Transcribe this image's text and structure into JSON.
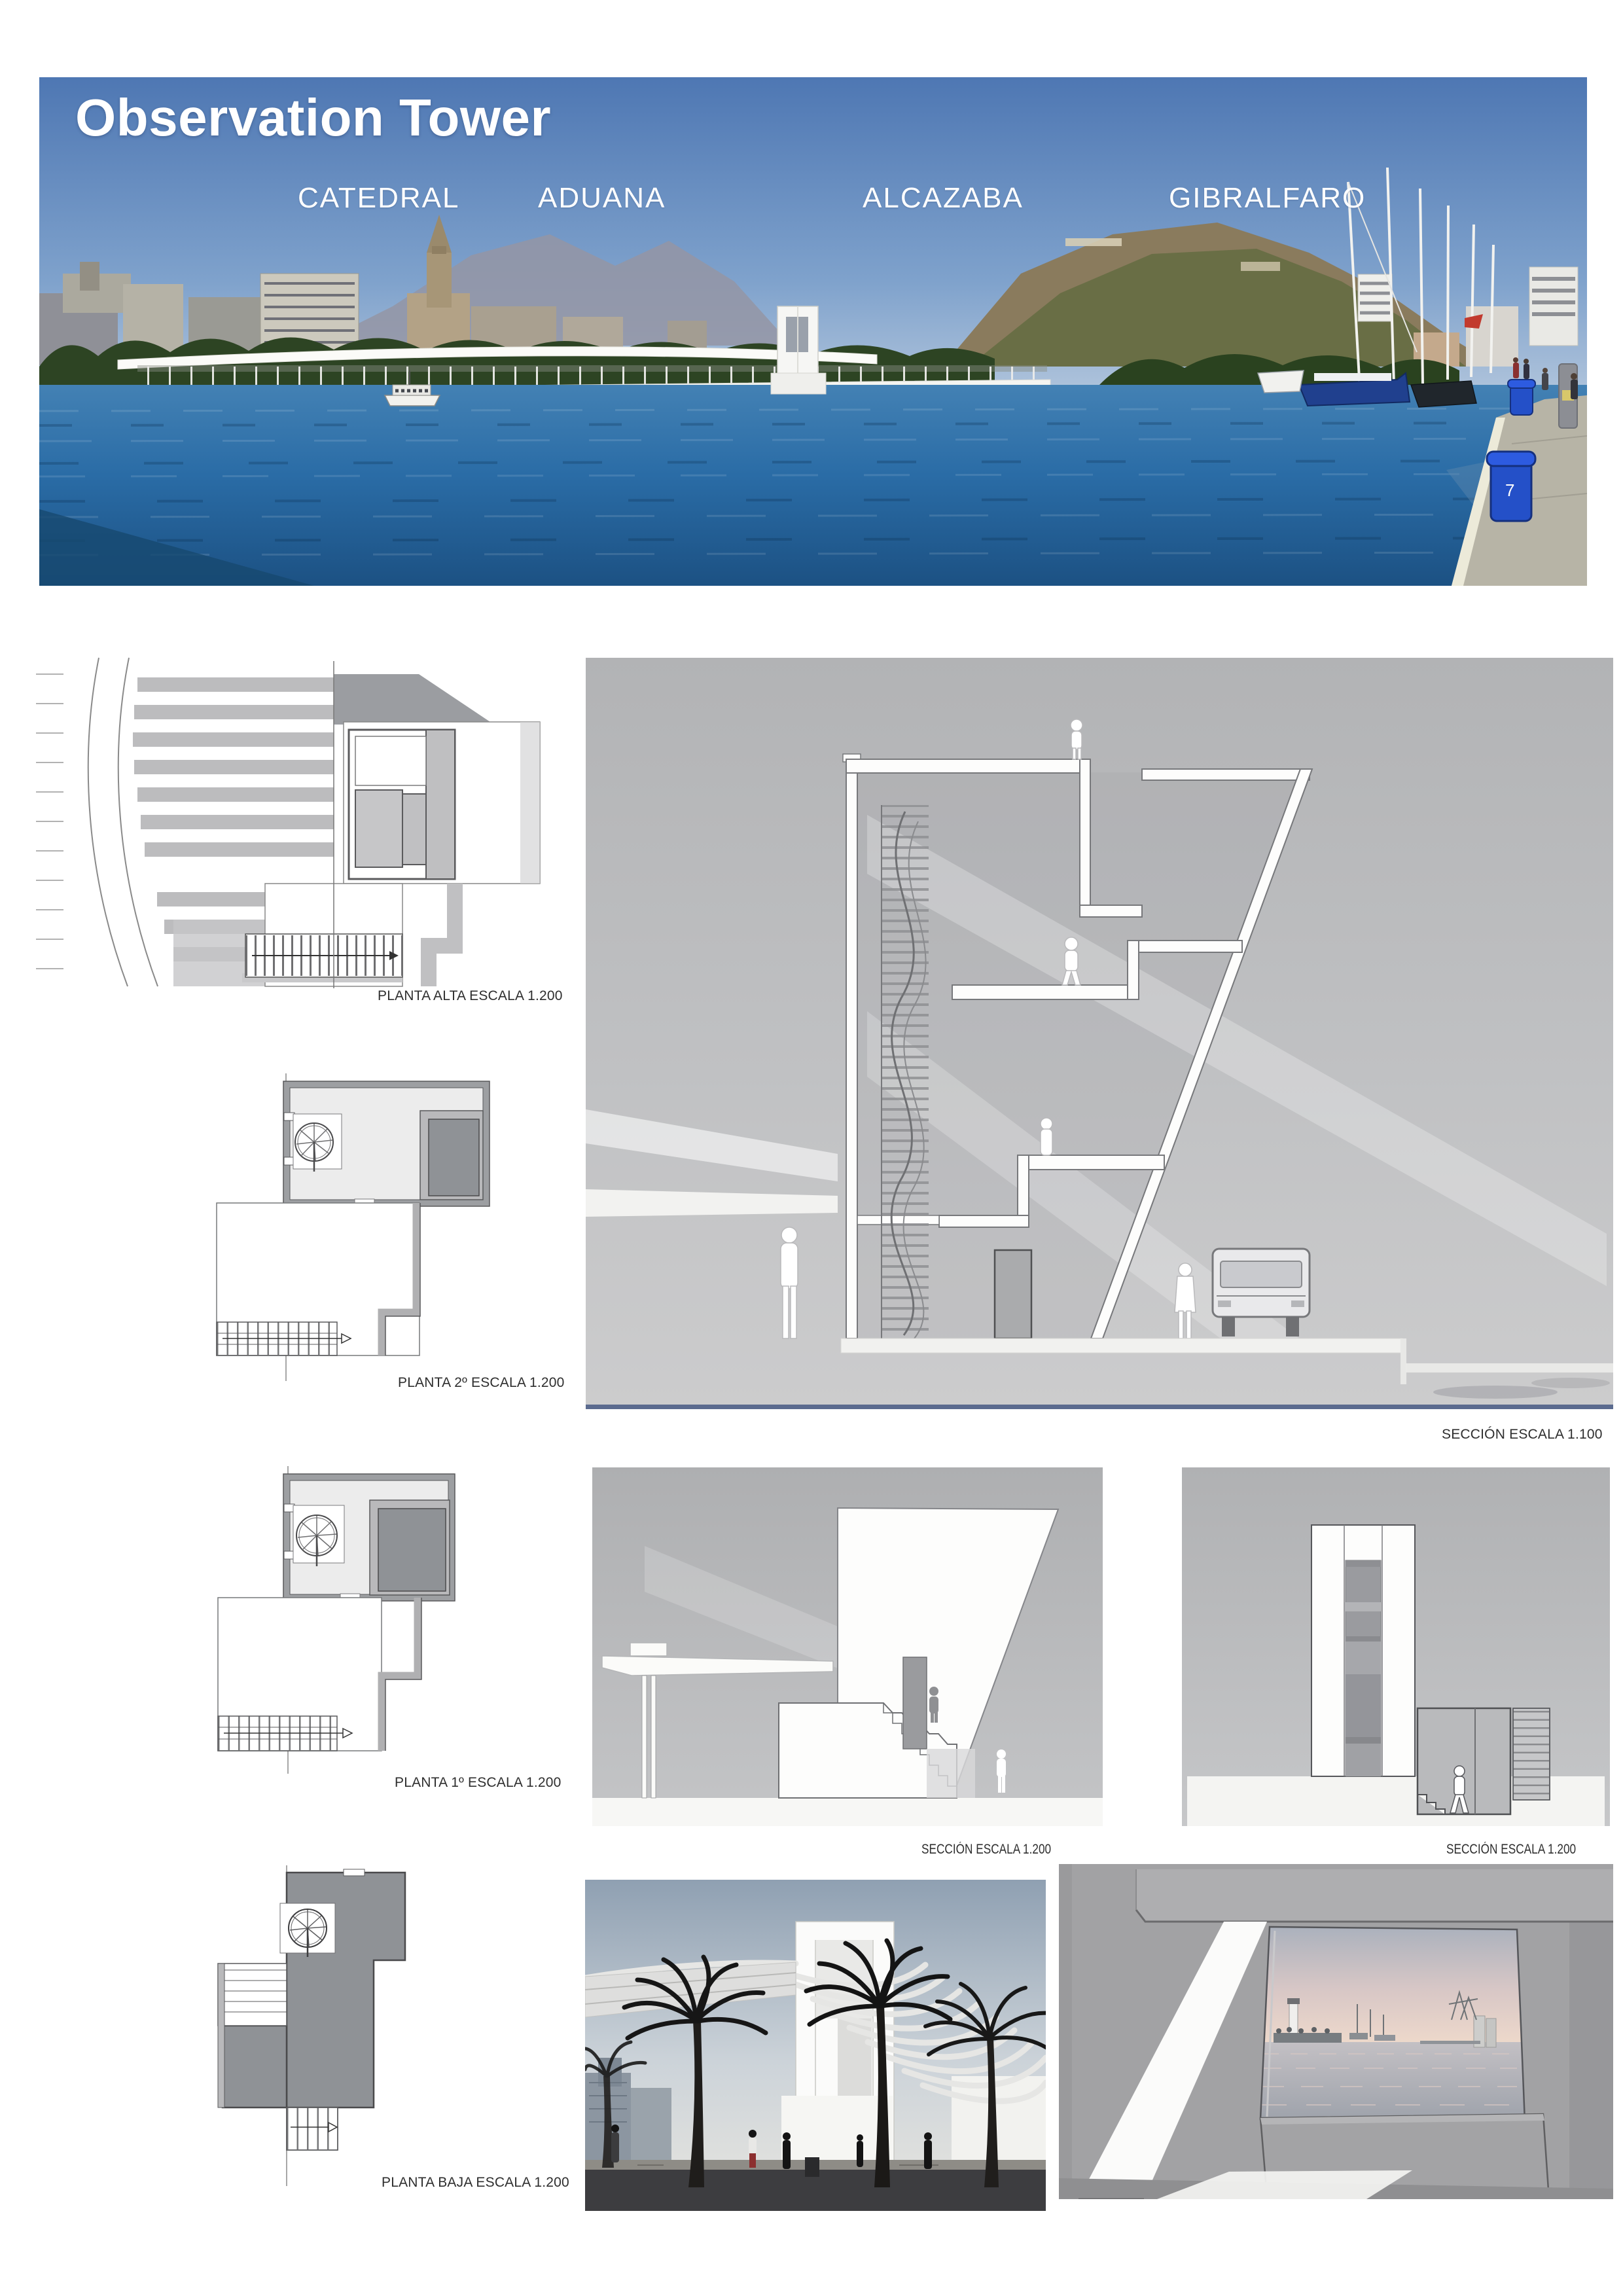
{
  "page": {
    "title": "Observation Tower"
  },
  "panorama": {
    "landmarks": [
      {
        "label": "CATEDRAL"
      },
      {
        "label": "ADUANA"
      },
      {
        "label": "ALCAZABA"
      },
      {
        "label": "GIBRALFARO"
      }
    ],
    "bollard_number": "7"
  },
  "plans": [
    {
      "label": "PLANTA ALTA ESCALA 1.200"
    },
    {
      "label": "PLANTA 2º ESCALA 1.200"
    },
    {
      "label": "PLANTA 1º ESCALA 1.200"
    },
    {
      "label": "PLANTA BAJA ESCALA 1.200"
    }
  ],
  "sections": {
    "main": {
      "label": "SECCIÓN ESCALA 1.100"
    },
    "west": {
      "label": "SECCIÓN ESCALA 1.200"
    },
    "east": {
      "label": "SECCIÓN ESCALA 1.200"
    }
  },
  "colors": {
    "sky_blue": "#4e77b3",
    "water_blue": "#2a6ca6",
    "drawing_sky_gray": "#bfc0c2",
    "plan_dark_gray": "#8f9296",
    "bollard_blue": "#2450c8",
    "harbor_dusk_pink": "#ecd4c8",
    "section_border_blue": "#5b6b8f"
  }
}
